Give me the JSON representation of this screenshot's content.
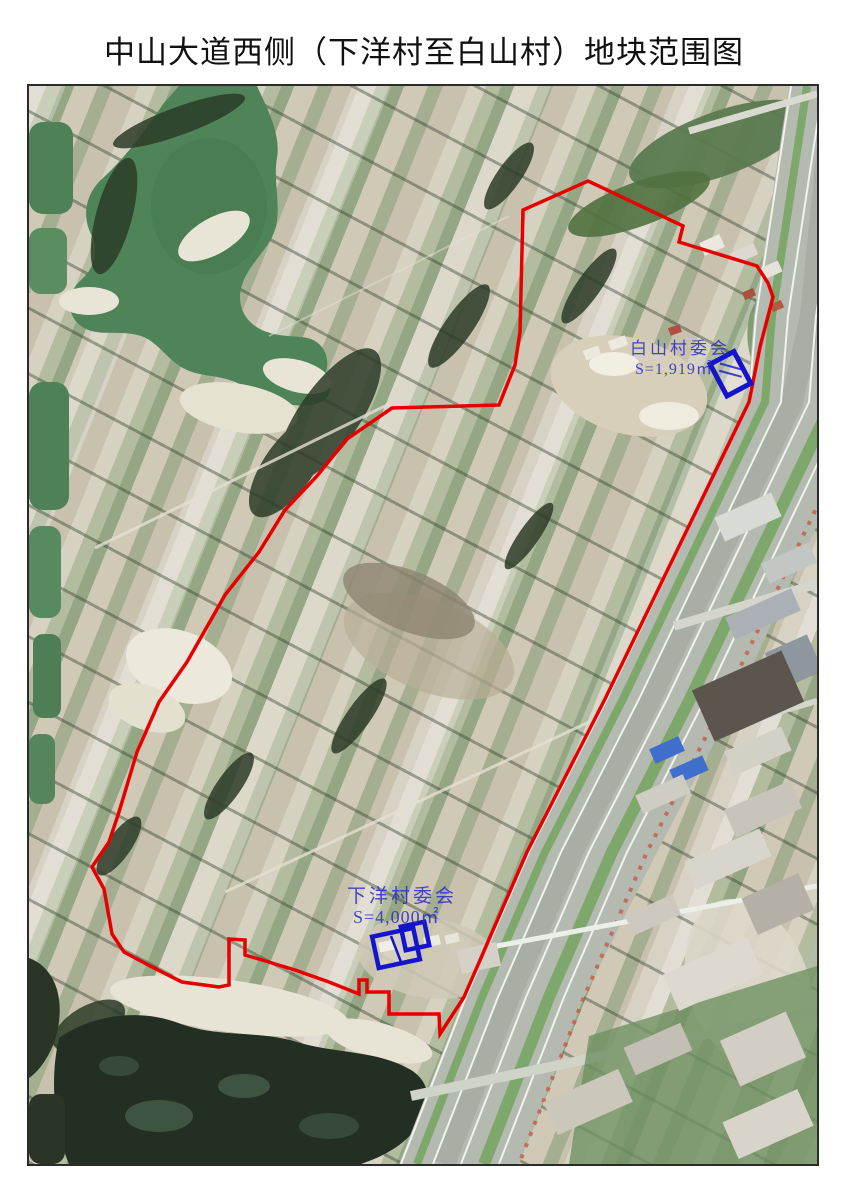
{
  "title": "中山大道西侧（下洋村至白山村）地块范围图",
  "map": {
    "annotations": [
      {
        "name": "白山村委会",
        "area": "S=1,919㎡"
      },
      {
        "name": "下洋村委会",
        "area": "S=4,000㎡"
      }
    ],
    "colors": {
      "boundary": "#e60000",
      "marker": "#1414cc",
      "label": "#2a2ac8"
    },
    "boundary_points": "559,95 654,140 650,156 728,180 739,197 744,211 731,261 720,316 576,613 498,766 435,911 411,948 410,928 360,928 360,906 338,906 338,894 330,894 330,908 300,896 266,884 233,874 216,869 216,854 200,853 200,899 190,901 153,896 123,881 95,866 83,848 75,803 63,781 80,756 90,726 108,666 130,616 158,576 196,509 230,466 256,424 288,390 318,353 363,322 470,319 486,279 491,246 494,124"
  }
}
